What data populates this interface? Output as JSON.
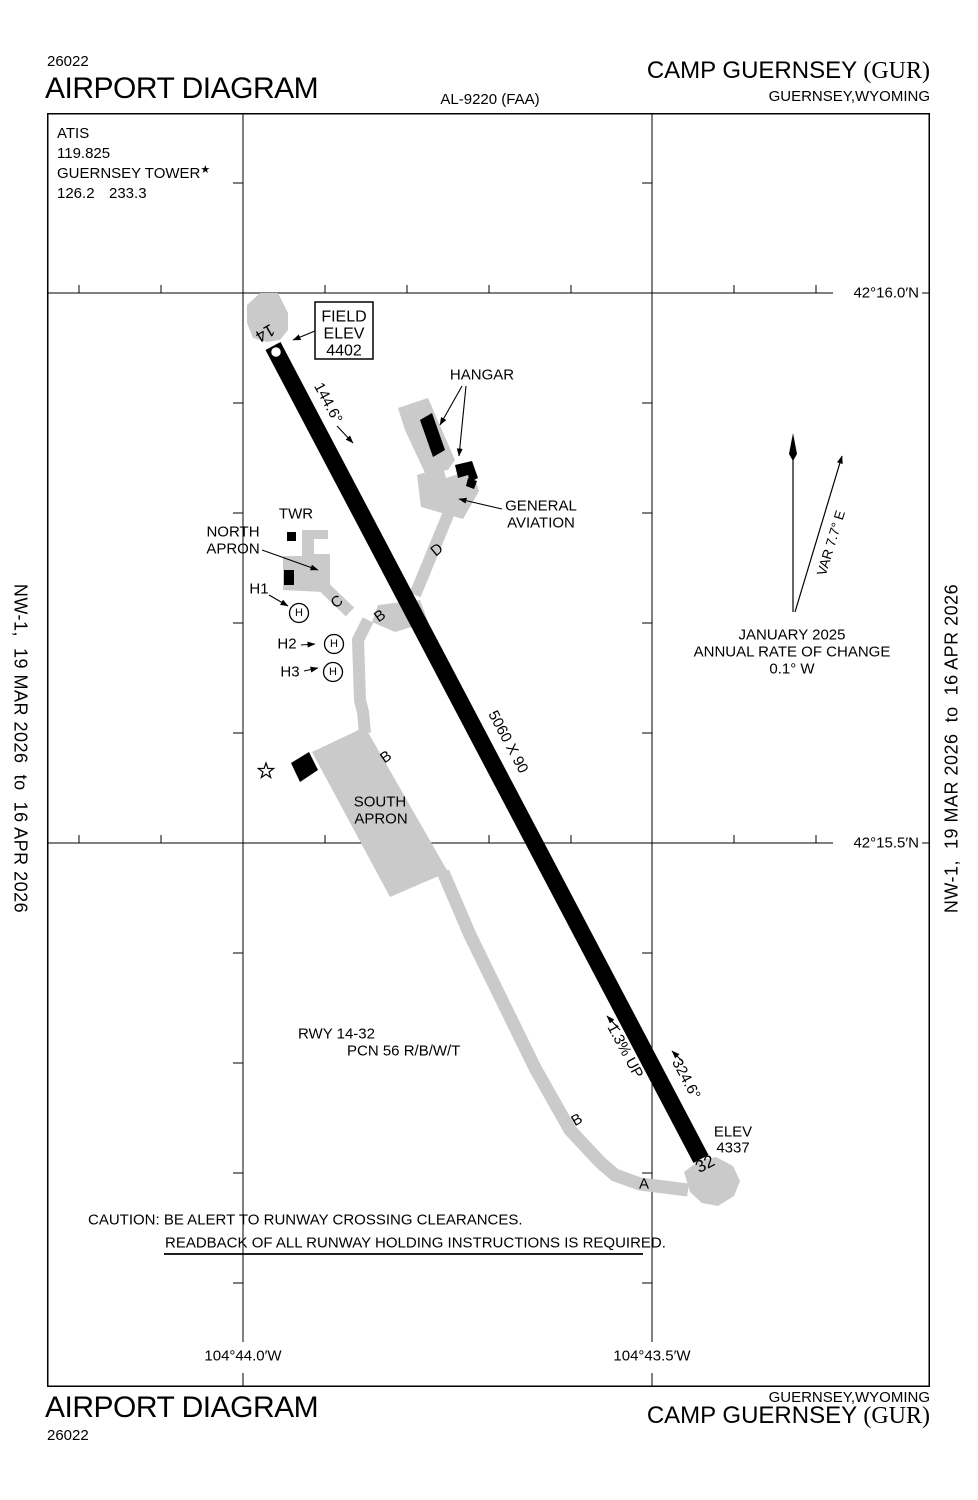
{
  "chart_number": "26022",
  "header": {
    "title": "AIRPORT DIAGRAM",
    "procedure_id": "AL-9220 (FAA)",
    "airport_name": "CAMP GUERNSEY",
    "airport_id": "(GUR)",
    "city_state": "GUERNSEY,WYOMING"
  },
  "footer": {
    "title": "AIRPORT DIAGRAM",
    "airport_name": "CAMP GUERNSEY",
    "airport_id": "(GUR)",
    "city_state": "GUERNSEY,WYOMING"
  },
  "sidebars": {
    "edition": "NW-1,  19 MAR 2026  to  16 APR 2026"
  },
  "comm_box": {
    "atis_label": "ATIS",
    "atis_freq": "119.825",
    "tower_label": "GUERNSEY TOWER",
    "tower_star": "★",
    "tower_freq_1": "126.2",
    "tower_freq_2": "233.3"
  },
  "field_elev": {
    "label1": "FIELD",
    "label2": "ELEV",
    "value": "4402"
  },
  "runway": {
    "num_14": "14",
    "num_32": "32",
    "dimensions": "5060 X 90",
    "heading_14": "144.6°",
    "heading_32": "324.6°",
    "slope": "1.3% UP",
    "elev_label": "ELEV",
    "elev_value": "4337",
    "info_line1": "RWY 14-32",
    "info_line2": "PCN 56 R/B/W/T"
  },
  "facilities": {
    "hangar": "HANGAR",
    "general_aviation_1": "GENERAL",
    "general_aviation_2": "AVIATION",
    "twr": "TWR",
    "north_apron_1": "NORTH",
    "north_apron_2": "APRON",
    "south_apron_1": "SOUTH",
    "south_apron_2": "APRON",
    "h1": "H1",
    "h2": "H2",
    "h3": "H3",
    "helipad_symbol": "H"
  },
  "taxiways": {
    "a": "A",
    "b": "B",
    "c": "C",
    "d": "D"
  },
  "variation": {
    "var_label": "VAR 7.7° E",
    "date": "JANUARY 2025",
    "rate_1": "ANNUAL RATE OF CHANGE",
    "rate_2": "0.1° W"
  },
  "caution": {
    "line1": "CAUTION: BE ALERT TO RUNWAY CROSSING CLEARANCES.",
    "line2": "READBACK OF ALL RUNWAY HOLDING INSTRUCTIONS IS REQUIRED."
  },
  "coordinates": {
    "lat_top": "42°16.0′N",
    "lat_bottom": "42°15.5′N",
    "lon_left": "104°44.0′W",
    "lon_right": "104°43.5′W"
  },
  "colors": {
    "pavement_gray": "#cacaca",
    "ink": "#000000"
  }
}
